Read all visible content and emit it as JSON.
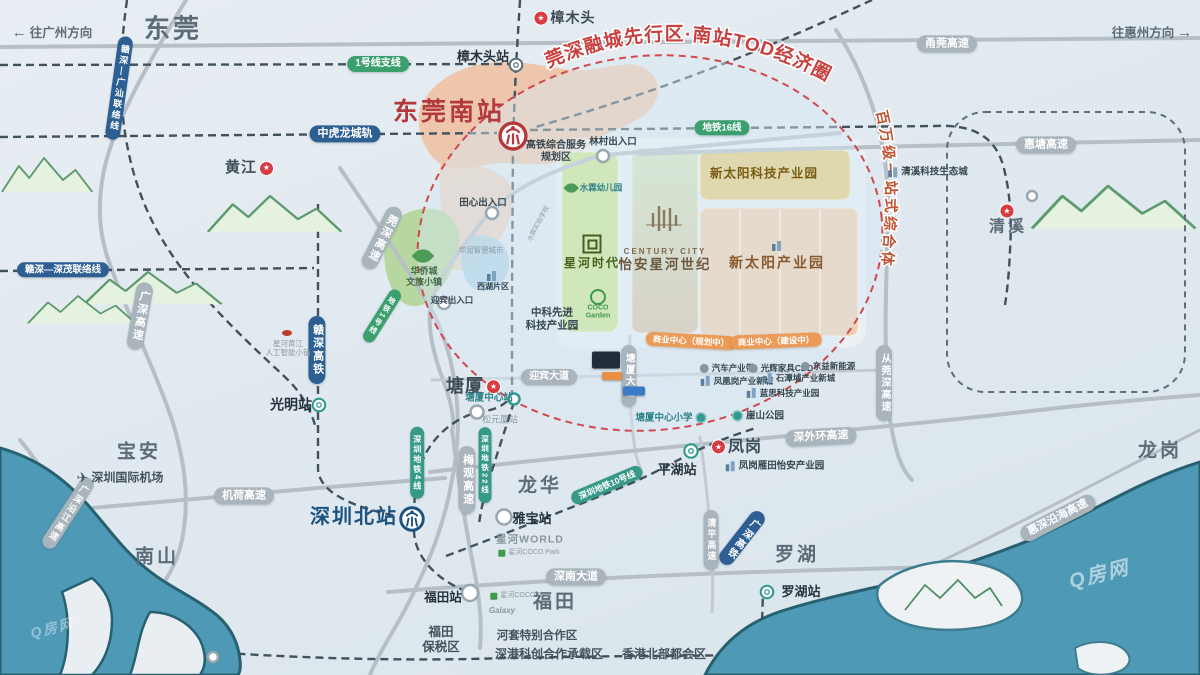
{
  "map": {
    "watermark": "Q房网",
    "curved": {
      "tod": "莞深融城先行区·南站TOD经济圈",
      "complex": "百万级一站式综合体"
    },
    "labels": [
      {
        "n": "direction-to-guangzhou",
        "t": "dir",
        "x": 52,
        "y": 33,
        "tx": "往广州方向",
        "arrow": "left",
        "fs": 12.5
      },
      {
        "n": "direction-to-huizhou",
        "t": "dir",
        "x": 1152,
        "y": 33,
        "tx": "往惠州方向",
        "arrow": "right",
        "fs": 12.5
      },
      {
        "n": "city-dongguan",
        "t": "city",
        "x": 173,
        "y": 29,
        "tx": "东莞",
        "fs": 26
      },
      {
        "n": "city-baoan",
        "t": "city",
        "x": 139,
        "y": 453,
        "tx": "宝安",
        "fs": 19
      },
      {
        "n": "city-nanshan",
        "t": "city",
        "x": 157,
        "y": 558,
        "tx": "南山",
        "fs": 19
      },
      {
        "n": "city-longhua",
        "t": "city",
        "x": 540,
        "y": 487,
        "tx": "龙华",
        "fs": 19
      },
      {
        "n": "city-luohu",
        "t": "city",
        "x": 797,
        "y": 556,
        "tx": "罗湖",
        "fs": 19
      },
      {
        "n": "city-futian",
        "t": "city",
        "x": 555,
        "y": 603,
        "tx": "福田",
        "fs": 19
      },
      {
        "n": "city-longgang",
        "t": "city",
        "x": 1160,
        "y": 452,
        "tx": "龙岗",
        "fs": 19
      },
      {
        "n": "poi-zhangmutou",
        "t": "star",
        "x": 565,
        "y": 18,
        "tx": "樟木头",
        "fs": 14,
        "icon": "star",
        "ipos": "left"
      },
      {
        "n": "poi-huangjiang",
        "t": "star",
        "x": 249,
        "y": 168,
        "tx": "黄江",
        "fs": 15,
        "icon": "star",
        "ipos": "right"
      },
      {
        "n": "poi-tangxia",
        "t": "star",
        "x": 473,
        "y": 387,
        "tx": "塘厦",
        "fs": 18,
        "icon": "star",
        "ipos": "right"
      },
      {
        "n": "poi-fenggang",
        "t": "star",
        "x": 737,
        "y": 447,
        "tx": "凤岗",
        "fs": 16,
        "icon": "star",
        "ipos": "left"
      },
      {
        "n": "qingxi-star-icon",
        "t": "icon",
        "icon": "star",
        "x": 1007,
        "y": 211
      },
      {
        "n": "poi-qingxi",
        "t": "city",
        "x": 1008,
        "y": 227,
        "tx": "清溪",
        "fs": 16
      },
      {
        "n": "station-dongguan-south",
        "t": "red-big",
        "x": 449,
        "y": 112,
        "tx": "东莞南站"
      },
      {
        "n": "station-dongguan-south-icon",
        "t": "icon",
        "icon": "rail-red",
        "x": 513,
        "y": 136,
        "isz": 31
      },
      {
        "n": "station-shenzhen-north",
        "t": "blue-big",
        "x": 354,
        "y": 517,
        "tx": "深圳北站"
      },
      {
        "n": "station-shenzhen-north-icon",
        "t": "icon",
        "icon": "rail-blue",
        "x": 412,
        "y": 519,
        "isz": 27
      },
      {
        "n": "station-zhangmutou",
        "t": "stn",
        "x": 483,
        "y": 57,
        "tx": "樟木头站",
        "fs": 13
      },
      {
        "n": "station-zhangmutou-icon",
        "t": "icon",
        "icon": "metro-ring",
        "x": 516,
        "y": 65,
        "isz": 17
      },
      {
        "n": "station-guangming",
        "t": "stn",
        "x": 291,
        "y": 405,
        "tx": "光明站",
        "fs": 14
      },
      {
        "n": "station-guangming-icon",
        "t": "icon",
        "icon": "stn-teal",
        "x": 319,
        "y": 405,
        "isz": 17
      },
      {
        "n": "station-pinghu",
        "t": "stn",
        "x": 677,
        "y": 470,
        "tx": "平湖站",
        "fs": 13
      },
      {
        "n": "station-pinghu-icon",
        "t": "icon",
        "icon": "stn-teal",
        "x": 691,
        "y": 451,
        "isz": 18
      },
      {
        "n": "station-luohu",
        "t": "stn",
        "x": 801,
        "y": 592,
        "tx": "罗湖站",
        "fs": 13
      },
      {
        "n": "station-luohu-icon",
        "t": "icon",
        "icon": "stn-teal",
        "x": 767,
        "y": 592,
        "isz": 17
      },
      {
        "n": "station-futian",
        "t": "stn",
        "x": 443,
        "y": 598,
        "tx": "福田站",
        "fs": 12.5
      },
      {
        "n": "station-yabao",
        "t": "stn",
        "x": 532,
        "y": 519,
        "tx": "雅宝站",
        "fs": 13
      },
      {
        "n": "station-tangxia-center",
        "t": "poi",
        "x": 489,
        "y": 398,
        "tx": "塘厦中心站",
        "fs": 9.5,
        "tone": "teal"
      },
      {
        "n": "station-songyuanxia",
        "t": "poi",
        "x": 500,
        "y": 420,
        "tx": "松元厦站",
        "fs": 9,
        "tone": "gray"
      },
      {
        "n": "pill-yongguan-expressway",
        "t": "roadpill",
        "x": 947,
        "y": 44,
        "tx": "甬莞高速"
      },
      {
        "n": "pill-huitang-expressway",
        "t": "roadpill",
        "x": 1046,
        "y": 145,
        "tx": "惠塘高速"
      },
      {
        "n": "pill-jihe-expressway",
        "t": "roadpill",
        "x": 244,
        "y": 496,
        "tx": "机荷高速"
      },
      {
        "n": "pill-shenwaihuan-expressway",
        "t": "roadpill",
        "x": 821,
        "y": 437,
        "tx": "深外环高速",
        "rot": -3
      },
      {
        "n": "pill-shennan-avenue",
        "t": "roadpill",
        "x": 576,
        "y": 577,
        "tx": "深南大道"
      },
      {
        "n": "pill-yingbin-avenue",
        "t": "roadpill",
        "x": 549,
        "y": 377,
        "tx": "迎宾大道",
        "fs": 10
      },
      {
        "n": "pill-huishen-coastal-expressway",
        "t": "roadpill",
        "x": 1058,
        "y": 518,
        "tx": "惠深沿海高速",
        "rot": -27
      },
      {
        "n": "pill-guangshen-riverside-expressway",
        "t": "roadpill",
        "x": 68,
        "y": 513,
        "tx": "广深沿江高速",
        "v": 1,
        "rot": 33,
        "fs": 9
      },
      {
        "n": "pill-guangshen-expressway",
        "t": "roadpill",
        "x": 140,
        "y": 316,
        "tx": "广深高速",
        "v": 1,
        "rot": 10
      },
      {
        "n": "pill-guanshen-expressway",
        "t": "roadpill",
        "x": 382,
        "y": 238,
        "tx": "莞深高速",
        "v": 1,
        "rot": 27
      },
      {
        "n": "pill-meiguan-expressway",
        "t": "roadpill",
        "x": 467,
        "y": 480,
        "tx": "梅观高速",
        "v": 1
      },
      {
        "n": "pill-qingping-expressway",
        "t": "roadpill",
        "x": 711,
        "y": 540,
        "tx": "清平高速",
        "v": 1,
        "fs": 9
      },
      {
        "n": "pill-congguanshen-expressway",
        "t": "roadpill",
        "x": 884,
        "y": 383,
        "tx": "从莞深高速",
        "v": 1,
        "fs": 10
      },
      {
        "n": "pill-tangxia-avenue",
        "t": "roadpill",
        "x": 629,
        "y": 376,
        "tx": "塘厦大道",
        "v": 1,
        "fs": 9.5
      },
      {
        "n": "pill-zhonghulong-intercity",
        "t": "bluepill",
        "x": 345,
        "y": 134,
        "tx": "中虎龙城轨"
      },
      {
        "n": "pill-ganshen-guangshan-link",
        "t": "bluepill",
        "x": 119,
        "y": 88,
        "tx": "赣深—广汕联络线",
        "v": 1,
        "rot": 8,
        "fs": 9
      },
      {
        "n": "pill-ganshen-shenmao-link",
        "t": "bluepill",
        "x": 63,
        "y": 270,
        "tx": "赣深—深茂联络线",
        "fs": 9.5
      },
      {
        "n": "pill-ganshen-hsr",
        "t": "bluepill",
        "x": 317,
        "y": 350,
        "tx": "赣深高铁",
        "v": 1
      },
      {
        "n": "pill-guangshen-hsr",
        "t": "bluepill",
        "x": 742,
        "y": 538,
        "tx": "广深高铁",
        "v": 1,
        "rot": 38,
        "fs": 10
      },
      {
        "n": "pill-line1-branch",
        "t": "greenpill",
        "x": 378,
        "y": 64,
        "tx": "1号线支线",
        "fs": 10
      },
      {
        "n": "pill-metro-line16",
        "t": "greenpill",
        "x": 722,
        "y": 128,
        "tx": "地铁16线",
        "fs": 9.5
      },
      {
        "n": "pill-metro-line1",
        "t": "greenpill",
        "x": 382,
        "y": 316,
        "tx": "地铁1号线",
        "v": 1,
        "rot": 32,
        "fs": 7.5
      },
      {
        "n": "pill-sz-metro-line4",
        "t": "tealpill",
        "x": 417,
        "y": 463,
        "tx": "深圳地铁4线",
        "v": 1,
        "fs": 8
      },
      {
        "n": "pill-sz-metro-line22",
        "t": "tealpill",
        "x": 485,
        "y": 465,
        "tx": "深圳地铁22线",
        "v": 1,
        "fs": 7.5
      },
      {
        "n": "pill-sz-metro-line10",
        "t": "tealpill",
        "x": 607,
        "y": 485,
        "tx": "深圳地铁10号线",
        "rot": -23,
        "fs": 8.5
      },
      {
        "n": "poi-hsr-service-area",
        "t": "poi",
        "x": 556,
        "y": 152,
        "tx": "高铁综合服务",
        "tx2": "规划区",
        "fs": 10,
        "tone": "navy"
      },
      {
        "n": "poi-lincun-exit",
        "t": "poi",
        "x": 613,
        "y": 142,
        "tx": "林村出入口",
        "fs": 9.5,
        "tone": "navy"
      },
      {
        "n": "poi-tianxin-exit",
        "t": "poi",
        "x": 483,
        "y": 203,
        "tx": "田心出入口",
        "fs": 9.5,
        "tone": "navy"
      },
      {
        "n": "poi-yingbin-exit",
        "t": "poi",
        "x": 452,
        "y": 300,
        "tx": "迎宾出入口",
        "fs": 8.5,
        "tone": "navy"
      },
      {
        "n": "poi-shuilin-kindergarten",
        "t": "poi",
        "x": 594,
        "y": 188,
        "tx": "水霖幼儿园",
        "fs": 8.5,
        "tone": "teal",
        "icon": "leaf",
        "ipos": "left"
      },
      {
        "n": "poi-shuilin-school",
        "t": "poi",
        "x": 539,
        "y": 224,
        "tx": "水霖实验学校",
        "fs": 6.5,
        "tone": "gray",
        "rot": -62
      },
      {
        "n": "poi-huarun-smart-city",
        "t": "poi",
        "x": 481,
        "y": 250,
        "tx": "华润智慧城市",
        "fs": 7.5,
        "tone": "gray"
      },
      {
        "n": "poi-xihu-icon",
        "t": "icon",
        "icon": "bldg",
        "x": 492,
        "y": 276
      },
      {
        "n": "poi-xihu-area",
        "t": "poi",
        "x": 493,
        "y": 287,
        "tx": "西湖片区",
        "fs": 8,
        "tone": "navy"
      },
      {
        "n": "poi-oct-town-icon",
        "t": "icon",
        "icon": "leaf-big",
        "x": 423,
        "y": 256
      },
      {
        "n": "poi-oct-town",
        "t": "poi",
        "x": 424,
        "y": 277,
        "tx": "华侨城",
        "tx2": "文旅小镇",
        "fs": 9,
        "tone": "park"
      },
      {
        "n": "poi-zhongke-park",
        "t": "poi",
        "x": 552,
        "y": 319,
        "tx": "中科先进",
        "tx2": "科技产业园",
        "fs": 10.5,
        "tone": "navy"
      },
      {
        "n": "poi-xinghe-ai-icon",
        "t": "icon",
        "icon": "dot-red",
        "x": 287,
        "y": 333
      },
      {
        "n": "poi-xinghe-ai-town",
        "t": "poi",
        "x": 288,
        "y": 348,
        "tx": "星河黄江",
        "tx2": "人工智能小镇",
        "fs": 7.5,
        "tone": "gray"
      },
      {
        "n": "poi-qingxi-eco-city",
        "t": "poi",
        "x": 928,
        "y": 172,
        "tx": "清溪科技生态城",
        "fs": 9.5,
        "tone": "navy",
        "icon": "bldg",
        "ipos": "left"
      },
      {
        "n": "poi-fenggang-yantian-park",
        "t": "poi",
        "x": 775,
        "y": 466,
        "tx": "凤岗雁田怡安产业园",
        "fs": 9.5,
        "tone": "navy",
        "icon": "bldg",
        "ipos": "left"
      },
      {
        "n": "poi-tangxia-primary-school",
        "t": "poi",
        "x": 671,
        "y": 418,
        "tx": "塘厦中心小学",
        "fs": 9.5,
        "tone": "teal",
        "icon": "circ-teal",
        "ipos": "right"
      },
      {
        "n": "poi-yashan-park",
        "t": "poi",
        "x": 758,
        "y": 416,
        "tx": "崖山公园",
        "fs": 9.5,
        "tone": "navy",
        "icon": "circ-teal",
        "ipos": "left"
      },
      {
        "n": "poi-auto-industry-belt",
        "t": "poi",
        "x": 727,
        "y": 368,
        "tx": "汽车产业带",
        "fs": 8.5,
        "tone": "navy",
        "icon": "circ-gray",
        "ipos": "left"
      },
      {
        "n": "poi-guanghui-furniture-cbd",
        "t": "poi",
        "x": 781,
        "y": 368,
        "tx": "光辉家具CBD",
        "fs": 8.5,
        "tone": "navy",
        "icon": "circ-gray",
        "ipos": "left"
      },
      {
        "n": "poi-dongyi-new-energy",
        "t": "poi",
        "x": 828,
        "y": 366,
        "tx": "东益新能源",
        "fs": 8.5,
        "tone": "navy",
        "icon": "circ-gray",
        "ipos": "left"
      },
      {
        "n": "poi-fenghuanggang-new-city",
        "t": "poi",
        "x": 737,
        "y": 381,
        "tx": "凤凰岗产业新城",
        "fs": 8.5,
        "tone": "navy",
        "icon": "bldg",
        "ipos": "left"
      },
      {
        "n": "poi-shitanpu-new-city",
        "t": "poi",
        "x": 799,
        "y": 378,
        "tx": "石潭埔产业新城",
        "fs": 8.5,
        "tone": "navy",
        "icon": "bldg",
        "ipos": "left"
      },
      {
        "n": "poi-lansi-tech-park",
        "t": "poi",
        "x": 783,
        "y": 393,
        "tx": "蓝思科技产业园",
        "fs": 8.5,
        "tone": "navy",
        "icon": "bldg",
        "ipos": "left"
      },
      {
        "n": "poi-shenzhen-airport",
        "t": "poi",
        "x": 120,
        "y": 478,
        "tx": "深圳国际机场",
        "fs": 12,
        "tone": "navy2",
        "icon": "plane",
        "ipos": "left"
      },
      {
        "n": "poi-xinghe-world",
        "t": "poi",
        "x": 530,
        "y": 540,
        "tx": "星河WORLD",
        "fs": 10.5,
        "tone": "logo"
      },
      {
        "n": "poi-coco-park-1",
        "t": "poi",
        "x": 529,
        "y": 553,
        "tx": "星河COCO Park",
        "fs": 7,
        "tone": "gray",
        "icon": "sq-green",
        "ipos": "left"
      },
      {
        "n": "poi-coco-park-2",
        "t": "poi",
        "x": 521,
        "y": 596,
        "tx": "星河COCO Park",
        "fs": 7,
        "tone": "gray",
        "icon": "sq-green",
        "ipos": "left"
      },
      {
        "n": "poi-galaxy",
        "t": "poi",
        "x": 502,
        "y": 611,
        "tx": "Galaxy",
        "fs": 8,
        "tone": "logo-i"
      },
      {
        "n": "poi-futian-bonded-zone",
        "t": "poi",
        "x": 441,
        "y": 640,
        "tx": "福田",
        "tx2": "保税区",
        "fs": 12.5,
        "tone": "navy2"
      },
      {
        "n": "poi-hetao-zone",
        "t": "poi",
        "x": 537,
        "y": 637,
        "tx": "河套特别合作区",
        "fs": 11.5,
        "tone": "navy2"
      },
      {
        "n": "poi-shengang-zone",
        "t": "poi",
        "x": 549,
        "y": 654,
        "tx": "深港科创合作承载区",
        "fs": 12,
        "tone": "navy2"
      },
      {
        "n": "poi-hk-northern-metropolis",
        "t": "poi",
        "x": 664,
        "y": 654,
        "tx": "香港北部都会区",
        "fs": 12,
        "tone": "navy2"
      },
      {
        "n": "park-xintaiyang-tech",
        "t": "poi",
        "x": 764,
        "y": 174,
        "tx": "新太阳科技产业园",
        "fs": 12.5,
        "tone": "gold"
      },
      {
        "n": "park-xintaiyang-icon",
        "t": "icon",
        "icon": "bldg",
        "x": 777,
        "y": 246
      },
      {
        "n": "park-xintaiyang",
        "t": "poi",
        "x": 777,
        "y": 263,
        "tx": "新太阳产业园",
        "fs": 14,
        "tone": "brown"
      },
      {
        "n": "project-xinghe-shidai-logo",
        "t": "icon",
        "icon": "sq-logo",
        "x": 592,
        "y": 244
      },
      {
        "n": "project-xinghe-shidai",
        "t": "poi",
        "x": 592,
        "y": 263,
        "tx": "星河时代",
        "fs": 12,
        "tone": "leafdark"
      },
      {
        "n": "project-century-city-logo",
        "t": "icon",
        "icon": "cc-logo",
        "x": 664,
        "y": 218
      },
      {
        "n": "project-century-city-en",
        "t": "poi",
        "x": 665,
        "y": 252,
        "tx": "CENTURY CITY",
        "fs": 8,
        "tone": "ccgray"
      },
      {
        "n": "project-century-city",
        "t": "poi",
        "x": 665,
        "y": 265,
        "tx": "怡安星河世纪",
        "fs": 13.5,
        "tone": "olive"
      },
      {
        "n": "poi-coco-garden-icon",
        "t": "icon",
        "icon": "coco-ring",
        "x": 598,
        "y": 297
      },
      {
        "n": "poi-coco-garden",
        "t": "poi",
        "x": 598,
        "y": 313,
        "tx": "COCO",
        "tx2": "Garden",
        "fs": 7,
        "tone": "green"
      },
      {
        "n": "banner-business-center-planned",
        "t": "banner",
        "x": 691,
        "y": 341,
        "tx": "商业中心（规划中）",
        "rot": 3
      },
      {
        "n": "banner-business-center-building",
        "t": "banner",
        "x": 776,
        "y": 341,
        "tx": "商业中心（建设中）",
        "rot": -2
      },
      {
        "n": "landmark-card-dark",
        "t": "card",
        "x": 606,
        "y": 360,
        "w": 28,
        "h": 17,
        "bg": "#232c3a"
      },
      {
        "n": "landmark-card-orange",
        "t": "card",
        "x": 612,
        "y": 376,
        "w": 20,
        "h": 8,
        "bg": "#e8903f"
      },
      {
        "n": "landmark-card-blue",
        "t": "card",
        "x": 634,
        "y": 391,
        "w": 22,
        "h": 9,
        "bg": "#3a7bc8"
      }
    ]
  }
}
